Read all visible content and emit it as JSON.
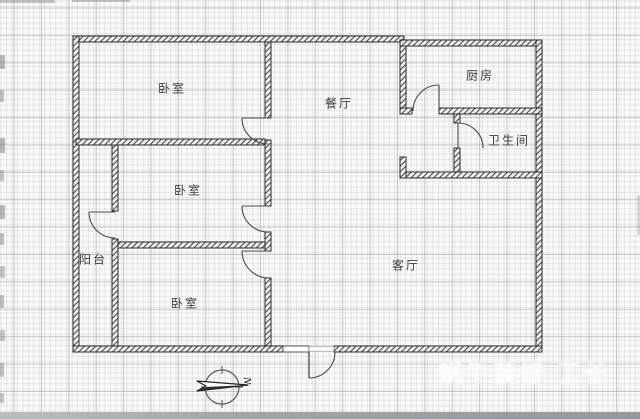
{
  "plan": {
    "rooms": [
      {
        "name": "bedroom-top",
        "label": "卧室"
      },
      {
        "name": "dining-room",
        "label": "餐厅"
      },
      {
        "name": "kitchen",
        "label": "厨房"
      },
      {
        "name": "bathroom",
        "label": "卫生间"
      },
      {
        "name": "bedroom-middle",
        "label": "卧室"
      },
      {
        "name": "balcony",
        "label": "阳台"
      },
      {
        "name": "bedroom-bottom",
        "label": "卧室"
      },
      {
        "name": "living-room",
        "label": "客厅"
      }
    ],
    "compass": {
      "north_label": "N"
    },
    "watermark": {
      "text": "蜗牛装修-工长"
    }
  },
  "colors": {
    "wall_line": "#2b2b2b",
    "wall_hatch": "#3a3a3a",
    "paper": "#f9f9f8",
    "grid_major": "#828a94",
    "grid_minor": "#969ea8",
    "label_text": "#3d3d3d",
    "watermark_white": "#ffffff"
  }
}
